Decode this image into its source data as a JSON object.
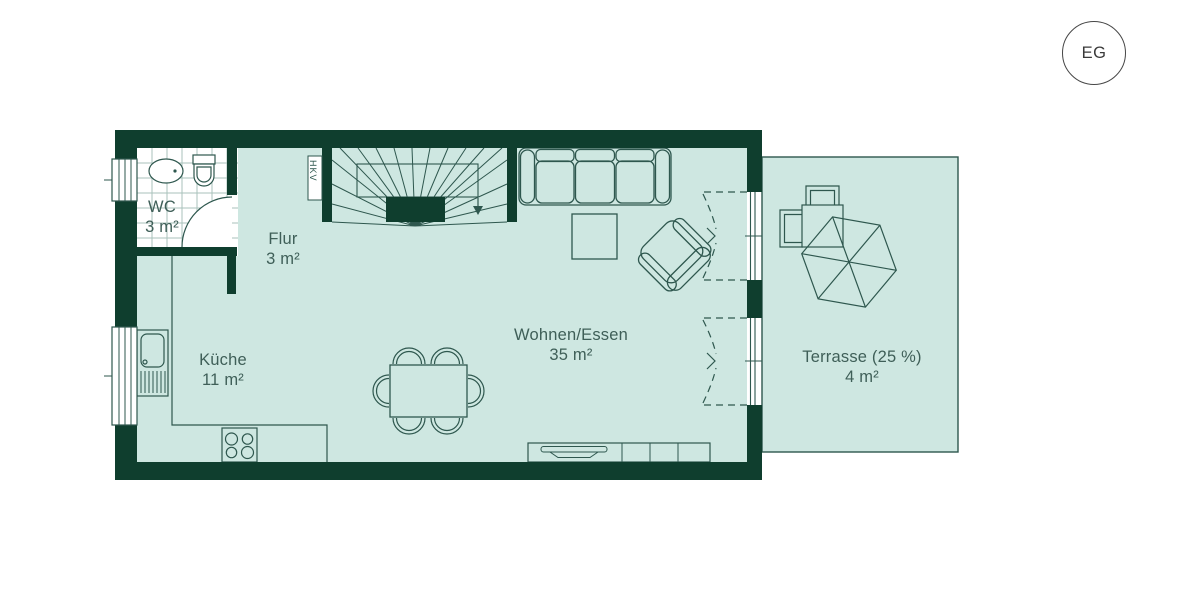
{
  "floor_badge": "EG",
  "rooms": {
    "wc": {
      "name": "WC",
      "area": "3 m²"
    },
    "flur": {
      "name": "Flur",
      "area": "3 m²"
    },
    "kueche": {
      "name": "Küche",
      "area": "11 m²"
    },
    "wohnen_essen": {
      "name": "Wohnen/Essen",
      "area": "35 m²"
    },
    "terrasse": {
      "name": "Terrasse (25 %)",
      "area": "4 m²"
    }
  },
  "annotations": {
    "hkv": "HKV"
  },
  "colors": {
    "wall": "#0f3e2e",
    "floor": "#cee7e1",
    "outline": "#2e574e",
    "text": "#3f5f58",
    "tile_line": "#a9c2bb",
    "badge_border": "#474747",
    "background": "#ffffff"
  }
}
